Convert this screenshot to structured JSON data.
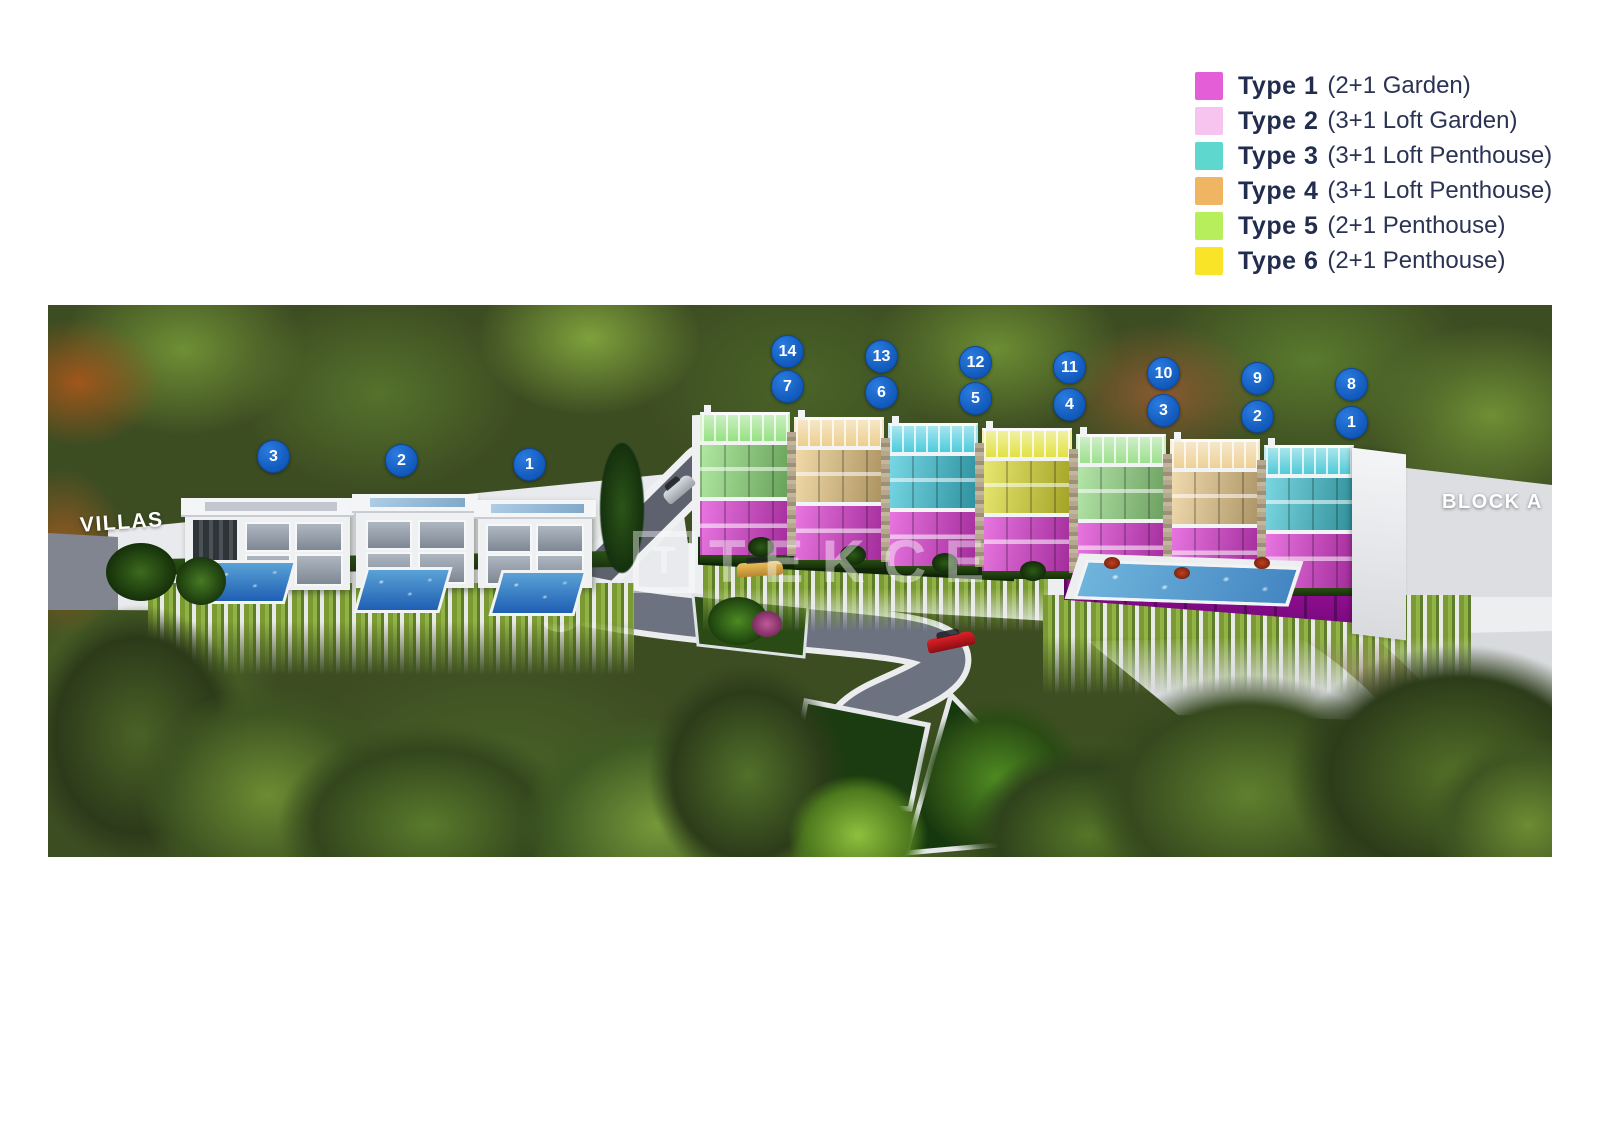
{
  "legend": {
    "items": [
      {
        "label": "Type 1",
        "desc": "(2+1 Garden)",
        "color": "#e45fd7"
      },
      {
        "label": "Type 2",
        "desc": "(3+1 Loft Garden)",
        "color": "#f7c4ef"
      },
      {
        "label": "Type 3",
        "desc": "(3+1 Loft Penthouse)",
        "color": "#5ed7cf"
      },
      {
        "label": "Type 4",
        "desc": "(3+1 Loft Penthouse)",
        "color": "#efb563"
      },
      {
        "label": "Type 5",
        "desc": "(2+1 Penthouse)",
        "color": "#b6ee5c"
      },
      {
        "label": "Type 6",
        "desc": "(2+1 Penthouse)",
        "color": "#f9e428"
      }
    ]
  },
  "scene": {
    "area_labels": {
      "villas": "VILLAS",
      "block": "BLOCK A"
    },
    "watermark": {
      "logo_letter": "T",
      "text": "TEKCE"
    },
    "villa_badges": [
      {
        "number": "3"
      },
      {
        "number": "2"
      },
      {
        "number": "1"
      }
    ],
    "block_units": [
      {
        "top_badge": "14",
        "bottom_badge": "7",
        "type": "Type 5",
        "penthouse_color": "#8ede79"
      },
      {
        "top_badge": "13",
        "bottom_badge": "6",
        "type": "Type 4",
        "penthouse_color": "#ecca84"
      },
      {
        "top_badge": "12",
        "bottom_badge": "5",
        "type": "Type 3",
        "penthouse_color": "#3ec7da"
      },
      {
        "top_badge": "11",
        "bottom_badge": "4",
        "type": "Type 6",
        "penthouse_color": "#dfdf34"
      },
      {
        "top_badge": "10",
        "bottom_badge": "3",
        "type": "Type 5",
        "penthouse_color": "#95dc85"
      },
      {
        "top_badge": "9",
        "bottom_badge": "2",
        "type": "Type 4",
        "penthouse_color": "#eccc8c"
      },
      {
        "top_badge": "8",
        "bottom_badge": "1",
        "type": "Type 3",
        "penthouse_color": "#42c6d4"
      }
    ],
    "garden_floor_color": "#df3bd4",
    "badge_color": "#1565c8"
  }
}
